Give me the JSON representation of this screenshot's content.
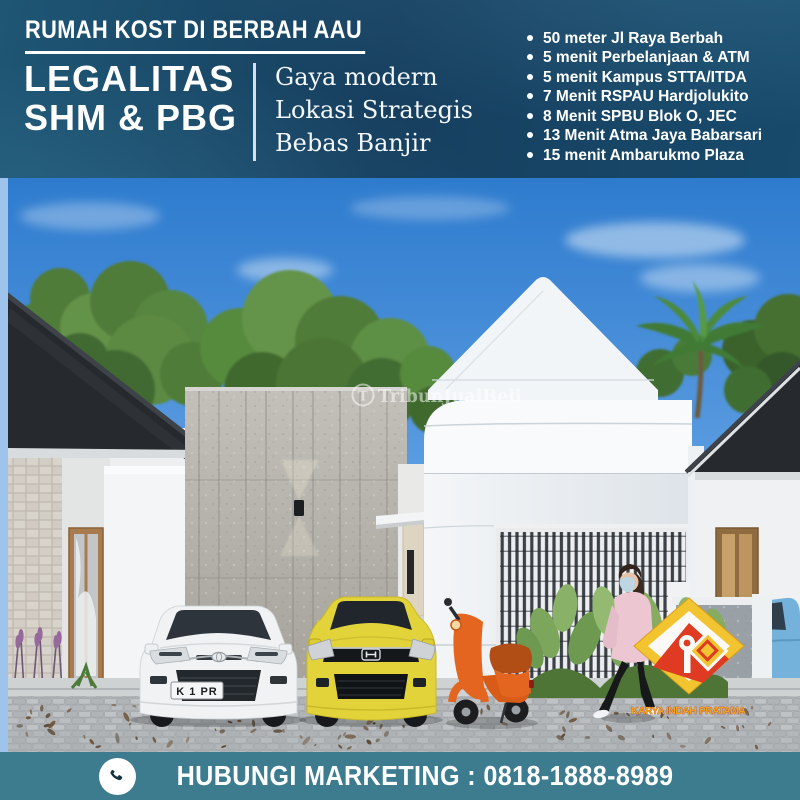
{
  "header": {
    "title": "RUMAH KOST DI BERBAH AAU",
    "legality_line1": "LEGALITAS",
    "legality_line2": "SHM & PBG",
    "features": [
      "Gaya modern",
      "Lokasi Strategis",
      "Bebas Banjir"
    ],
    "distances": [
      "50 meter Jl Raya Berbah",
      "5 menit Perbelanjaan & ATM",
      "5 menit Kampus STTA/ITDA",
      "7 Menit RSPAU Hardjolukito",
      "8 Menit SPBU Blok O, JEC",
      "13 Menit Atma Jaya Babarsari",
      "15 menit Ambarukmo Plaza"
    ]
  },
  "render": {
    "watermark_initial": "T",
    "watermark": "TribunJualBeli",
    "license_plate": "K 1 PR",
    "logo_text": "KARYA INDAH PRATAMA"
  },
  "footer": {
    "contact": "HUBUNGI MARKETING : 0818-1888-8989"
  },
  "colors": {
    "header_bg": "#174564",
    "footer_bg": "#3d7b8f",
    "sky_blue": "#3b84d4",
    "logo_yellow": "#f2c430",
    "logo_red": "#df3b22",
    "scooter_orange": "#e4651f",
    "car_yellow": "#e3d33b"
  }
}
